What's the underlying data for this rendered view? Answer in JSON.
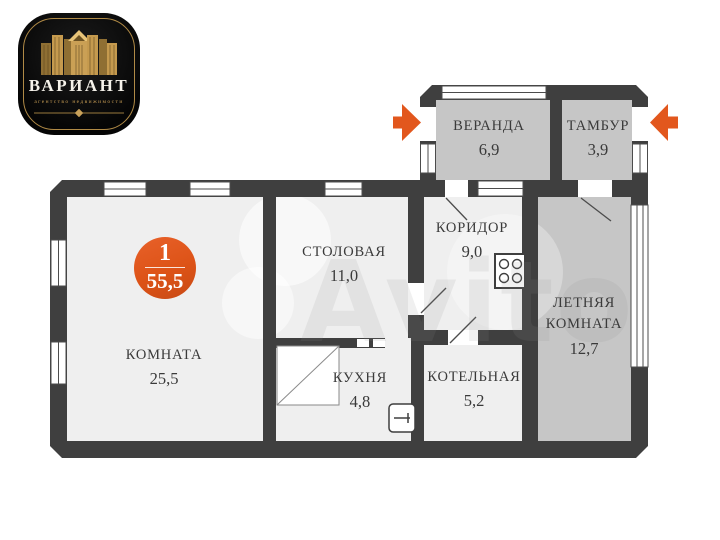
{
  "logo": {
    "brand": "ВАРИАНТ",
    "tagline": "агентство недвижимости"
  },
  "badge": {
    "number": "1",
    "total_area": "55,5"
  },
  "watermark": "Avito",
  "rooms": [
    {
      "id": "veranda",
      "name": "ВЕРАНДА",
      "area": "6,9"
    },
    {
      "id": "tambur",
      "name": "ТАМБУР",
      "area": "3,9"
    },
    {
      "id": "koridor",
      "name": "КОРИДОР",
      "area": "9,0"
    },
    {
      "id": "stolovaya",
      "name": "СТОЛОВАЯ",
      "area": "11,0"
    },
    {
      "id": "letnyaya",
      "name_lines": [
        "ЛЕТНЯЯ",
        "КОМНАТА"
      ],
      "area": "12,7"
    },
    {
      "id": "komnata",
      "name": "КОМНАТА",
      "area": "25,5"
    },
    {
      "id": "kuhnya",
      "name": "КУХНЯ",
      "area": "4,8"
    },
    {
      "id": "kotelnaya",
      "name": "КОТЕЛЬНАЯ",
      "area": "5,2"
    }
  ],
  "colors": {
    "wall": "#3f3f3f",
    "heated_room_fill": "#efefef",
    "unheated_room_fill": "#c6c6c6",
    "accent_orange": "#e2571d",
    "label_text": "#3a3a3a",
    "logo_gold": "#c49a52",
    "logo_background": "#0a0a0a"
  },
  "icons": [
    "entry-arrow-icon",
    "stove-icon",
    "sink-icon",
    "cabinet-icon",
    "window",
    "door-leaf",
    "buildings-logo-icon"
  ]
}
